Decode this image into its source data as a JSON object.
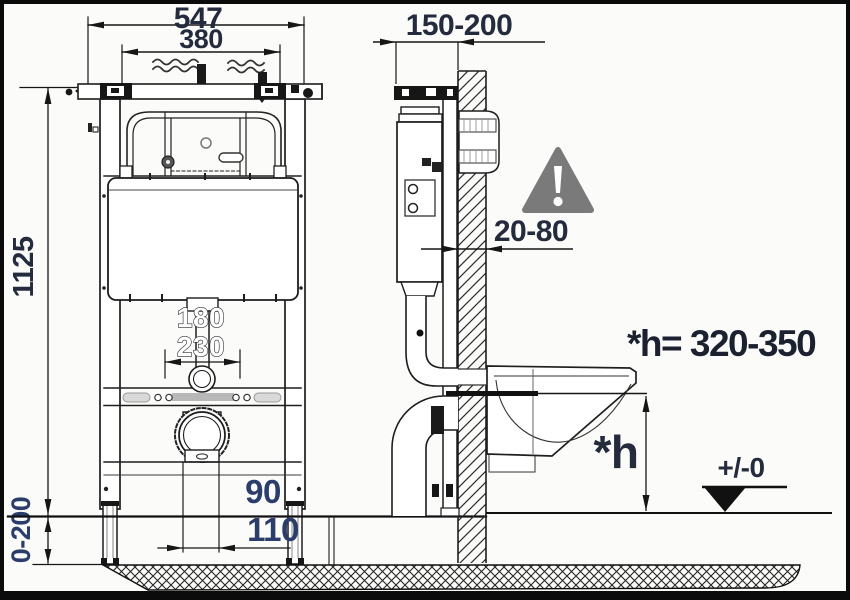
{
  "drawing_title": "wall-hung-wc-installation-frame-dimensions",
  "front_view": {
    "total_width": "547",
    "inner_width": "380",
    "frame_height": "1125",
    "foot_adjustment": "0-200",
    "flush_offset_a": "180",
    "flush_offset_b": "230",
    "outlet_offset_a": "90",
    "outlet_offset_b": "110"
  },
  "side_view": {
    "install_depth": "150-200",
    "finish_thickness": "20-80",
    "bowl_height_note": "*h= 320-350",
    "bowl_height_symbol": "*h",
    "floor_level": "+/-0"
  },
  "icons": {
    "warning": "warning-triangle-exclamation"
  },
  "colors": {
    "line": "#161616",
    "dimension_text": "#232b3d",
    "dimension_text_blue": "#2b3e6b",
    "warning_gray": "#7a7a7a",
    "background": "#fbfbfa"
  }
}
